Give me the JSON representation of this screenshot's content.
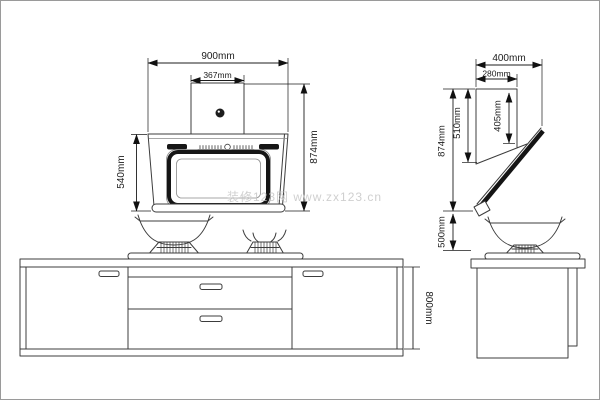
{
  "watermark": {
    "text": "装修123网 www.zx123.cn"
  },
  "front_view": {
    "total_width": "900mm",
    "duct_width": "367mm",
    "body_height": "540mm",
    "total_height": "874mm"
  },
  "side_view": {
    "total_depth": "400mm",
    "duct_depth": "280mm",
    "panel_length": "405mm",
    "body_height": "510mm",
    "total_height": "874mm",
    "hood_clearance": "500mm"
  },
  "cabinet": {
    "height": "800mm"
  }
}
